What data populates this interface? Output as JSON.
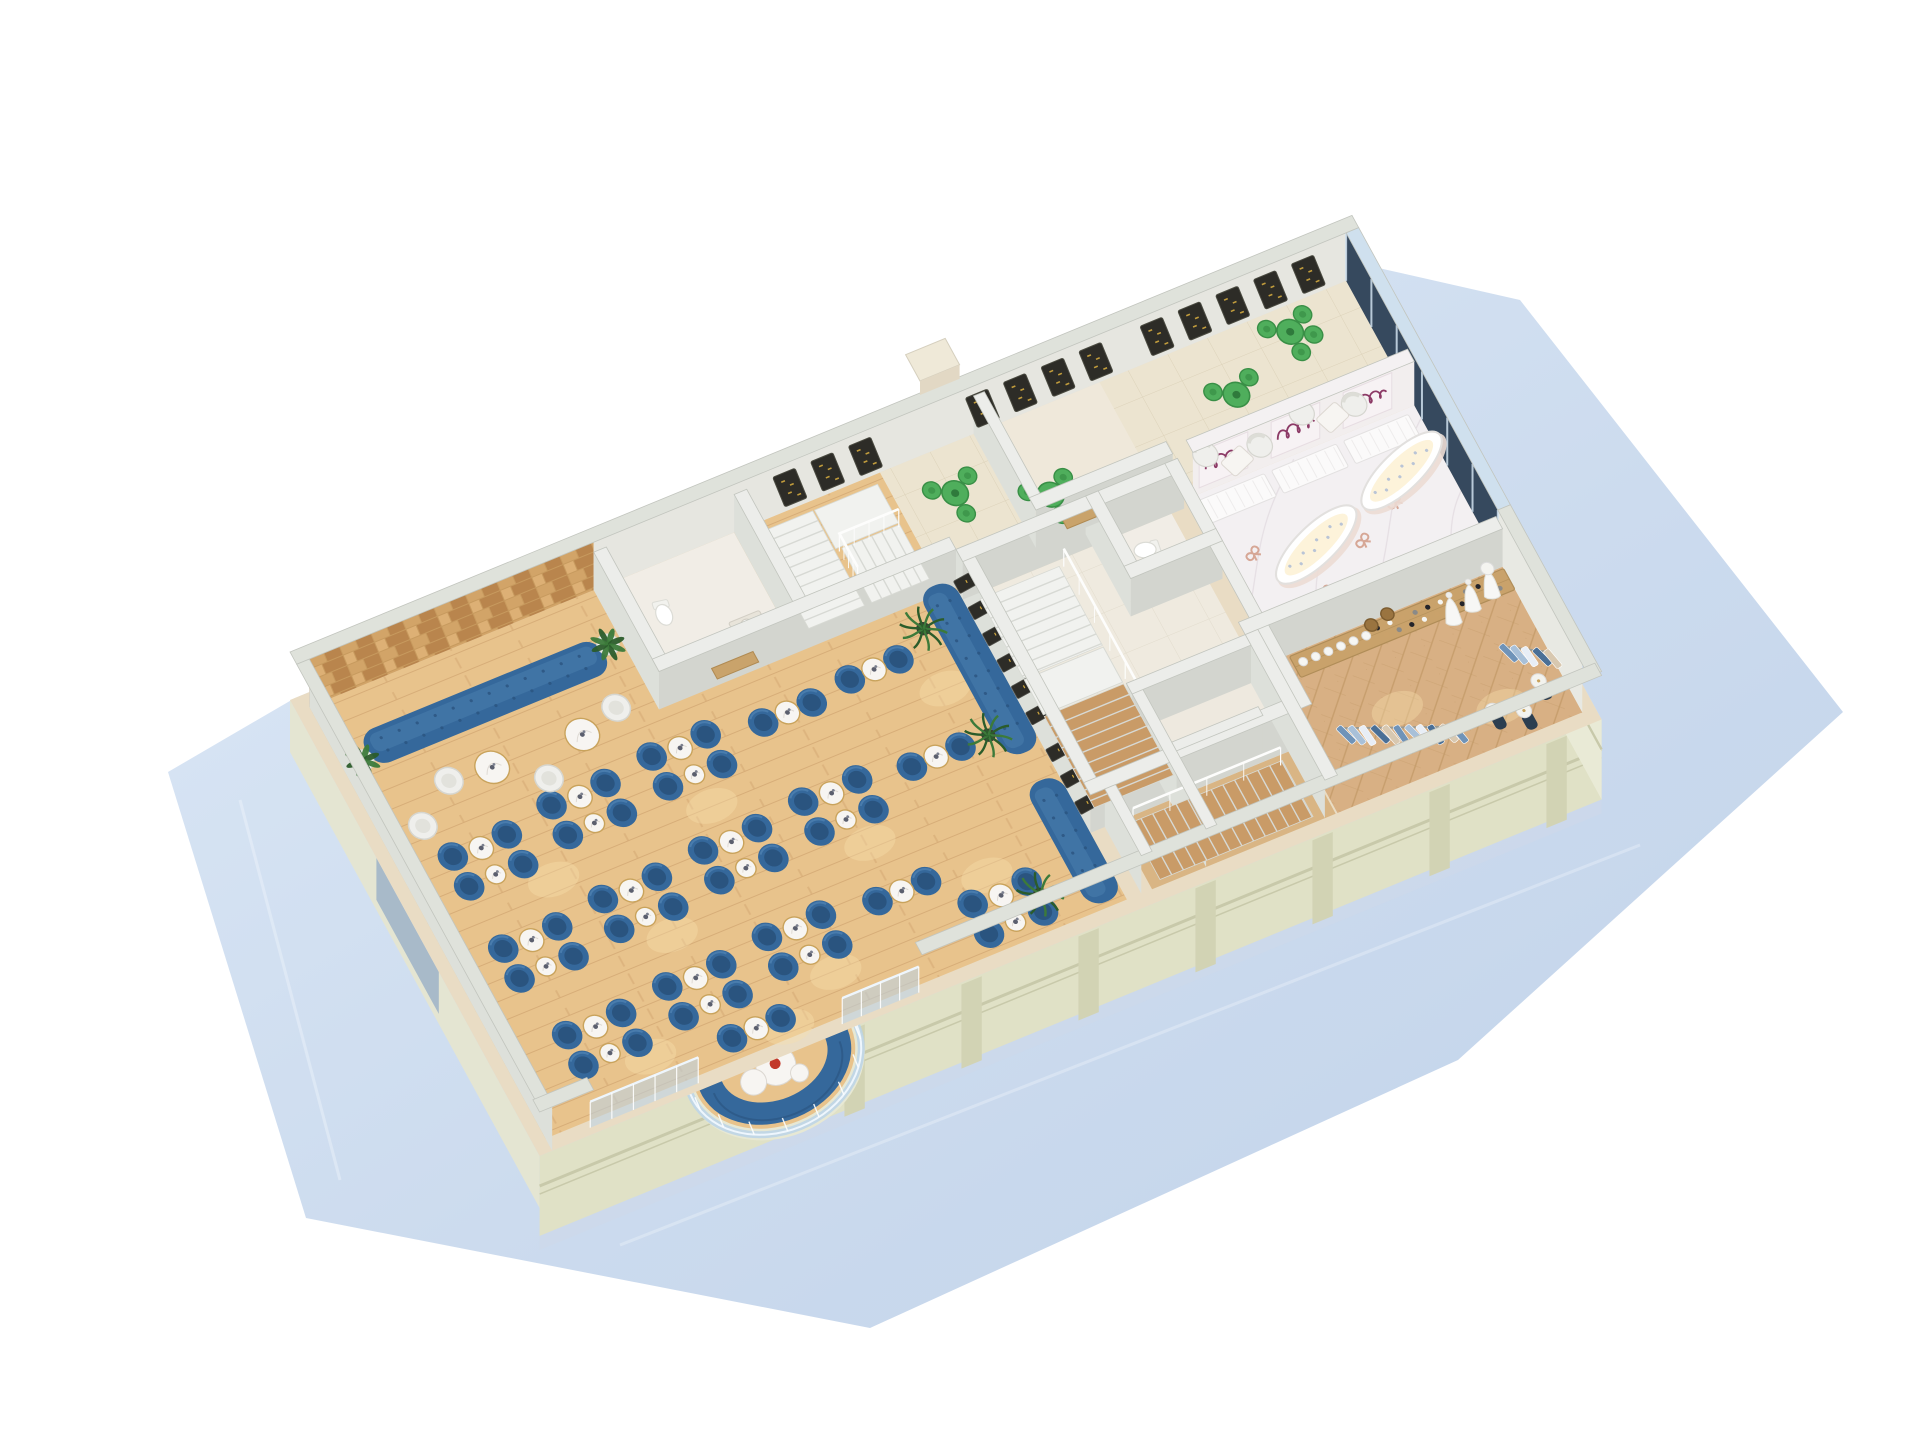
{
  "scene": {
    "kind": "isometric-cutaway-floorplan-render",
    "areas": [
      {
        "name": "lounge",
        "floor": "wood"
      },
      {
        "name": "restaurant-dining",
        "floor": "wood"
      },
      {
        "name": "cafe-terrace",
        "floor": "tile"
      },
      {
        "name": "jewelry-boutique",
        "floor": "marble"
      },
      {
        "name": "fashion-boutique",
        "floor": "herringbone"
      },
      {
        "name": "fitting-rooms",
        "floor": "tile"
      },
      {
        "name": "stair-halls",
        "floor": "mixed"
      },
      {
        "name": "restrooms",
        "floor": "tile"
      }
    ]
  },
  "palette": {
    "plane1": "#dbe7f6",
    "plane2": "#c3d4ec",
    "plane3": "#eaf1fa",
    "plane_edge": "#b9cde6",
    "facade": "#e0e1c6",
    "facade_dark": "#d2d3b4",
    "facade_side": "#e4e5d2",
    "molding": "#c8c9aa",
    "cut": "#dfe2db",
    "cut_edge": "#c2c5be",
    "int_top": "#ecedea",
    "face_s": "#d3d5cf",
    "face_w": "#dde0da",
    "face_back": "#e6e6e0",
    "wood": "#e8c38c",
    "wood_line": "#d3a873",
    "wood_light": "#f7dfae",
    "tile": "#ece4d0",
    "tile_line": "#dcd2b9",
    "core_floor": "#efeadf",
    "wc_floor": "#f1ede6",
    "marble_floor": "#f3f0f2",
    "marble_vein": "#e1dae0",
    "herr": "#d8b084",
    "herr_dark": "#c39a68",
    "mosaic1": "#d2a468",
    "mosaic2": "#b9854d",
    "mosaic3": "#c79a5e",
    "mosaic4": "#ddb075",
    "blue": "#35689b",
    "blue_dark": "#2a547f",
    "blue_light": "#4e82b2",
    "white_seat": "#efefec",
    "white_seat_edge": "#d6d6d0",
    "marble_table": "#f7f5f2",
    "gold": "#c9a35c",
    "green": "#4fae5c",
    "green_dark": "#398f46",
    "frame_dark": "#2d2c27",
    "frame_gold": "#d1a93f",
    "sign_bg": "#f7f2f4",
    "script": "#8c3a66",
    "glass": "#b9d4ea",
    "glass_line": "#eef6fd",
    "stair": "#f1f2ef",
    "stair_shadow": "#d7d9d4",
    "stair_wood": "#c99b67",
    "plant": "#3c7a3a",
    "plant_dark": "#2b5c2b",
    "pot": "#f4f4f1",
    "red": "#c2392a",
    "glow": "#fdf3da",
    "rosegold": "#d29b86",
    "shelf": "#c9a26b",
    "denim": "#6f93b8",
    "denim_light": "#a8c0d8",
    "navy": "#2c3e50",
    "window_dark": "#36495e",
    "window_cap": "#cfe0ee",
    "door_wood": "#c9a36b"
  },
  "restaurant": {
    "clusters": [
      [
        100,
        225,
        "q"
      ],
      [
        215,
        215,
        "q"
      ],
      [
        330,
        208,
        "q"
      ],
      [
        445,
        202,
        "p"
      ],
      [
        100,
        330,
        "q"
      ],
      [
        215,
        322,
        "q"
      ],
      [
        330,
        315,
        "q"
      ],
      [
        445,
        308,
        "q"
      ],
      [
        115,
        435,
        "q"
      ],
      [
        230,
        428,
        "q"
      ],
      [
        345,
        420,
        "q"
      ],
      [
        460,
        412,
        "p"
      ],
      [
        260,
        484,
        "p"
      ],
      [
        545,
        195,
        "p"
      ],
      [
        558,
        300,
        "p"
      ],
      [
        548,
        468,
        "q"
      ]
    ],
    "sofas": [
      {
        "x": 44,
        "y": 58,
        "len": 264,
        "dir": "u"
      },
      {
        "x": 622,
        "y": 140,
        "len": 190,
        "dir": "v"
      },
      {
        "x": 622,
        "y": 362,
        "len": 138,
        "dir": "v"
      }
    ],
    "palms": [
      [
        616,
        300
      ],
      [
        584,
        468
      ],
      [
        610,
        176
      ]
    ],
    "light_pools": [
      [
        150,
        268
      ],
      [
        330,
        260
      ],
      [
        230,
        365
      ],
      [
        455,
        355
      ],
      [
        150,
        470
      ],
      [
        360,
        462
      ],
      [
        545,
        430
      ],
      [
        290,
        495
      ],
      [
        600,
        240
      ],
      [
        520,
        120
      ],
      [
        1000,
        432
      ],
      [
        1096,
        470
      ]
    ]
  },
  "lounge": {
    "tables": [
      [
        150,
        140
      ],
      [
        248,
        144
      ]
    ],
    "egg_chairs": [
      [
        104,
        136
      ],
      [
        196,
        172
      ],
      [
        292,
        132
      ],
      [
        58,
        168
      ]
    ],
    "plants": [
      [
        36,
        84
      ],
      [
        316,
        70
      ]
    ]
  },
  "cafe": {
    "sets": [
      [
        706,
        62,
        3
      ],
      [
        792,
        100,
        3
      ],
      [
        1090,
        40,
        4
      ],
      [
        1010,
        78,
        2
      ]
    ],
    "armchairs": [
      [
        952,
        122
      ],
      [
        1006,
        134
      ],
      [
        1060,
        120
      ],
      [
        1112,
        132
      ]
    ],
    "coffee_tables": [
      [
        978,
        140
      ],
      [
        1086,
        136
      ]
    ]
  },
  "jewelry": {
    "counters": [
      924,
      1004,
      1084
    ],
    "sign_panels": [
      954,
      1034,
      1114
    ],
    "vitrines": [
      [
        1008,
        248,
        -21
      ],
      [
        1122,
        212,
        -21
      ]
    ],
    "floor_decals": [
      [
        946,
        232
      ],
      [
        992,
        296
      ],
      [
        1052,
        262
      ],
      [
        1128,
        300
      ],
      [
        936,
        312
      ],
      [
        1100,
        238
      ]
    ]
  },
  "boutique": {
    "shoe_shelf": {
      "x": 928,
      "y": 342,
      "w": 238,
      "h": 24
    },
    "busts_x": [
      938,
      952,
      966,
      980,
      994,
      1008
    ],
    "shoes_x_from": 1022,
    "shoes_x_to": 1160,
    "baskets": [
      [
        1018,
        344
      ],
      [
        1038,
        340
      ]
    ],
    "gowns": [
      [
        1098,
        362
      ],
      [
        1122,
        357
      ],
      [
        1146,
        352
      ]
    ],
    "racks": [
      {
        "x1": 938,
        "y1": 428,
        "x2": 1042,
        "y2": 470,
        "n": 11
      },
      {
        "x1": 1126,
        "y1": 414,
        "x2": 1164,
        "y2": 436,
        "n": 5
      }
    ],
    "mannequins": [
      [
        1086,
        482
      ],
      [
        1114,
        494
      ],
      [
        1142,
        472
      ]
    ]
  },
  "wall_frames": {
    "menu_x": [
      548,
      590,
      632,
      762,
      804,
      846,
      888,
      956,
      998,
      1040,
      1082,
      1124
    ],
    "small_y": [
      168,
      198,
      228,
      258,
      288,
      318,
      360,
      390,
      420
    ]
  },
  "bay": {
    "tables": [
      [
        0,
        6,
        20,
        "red"
      ],
      [
        -27,
        13,
        13,
        ""
      ],
      [
        19,
        22,
        9,
        ""
      ]
    ]
  },
  "windows": {
    "right_panels": 6
  }
}
